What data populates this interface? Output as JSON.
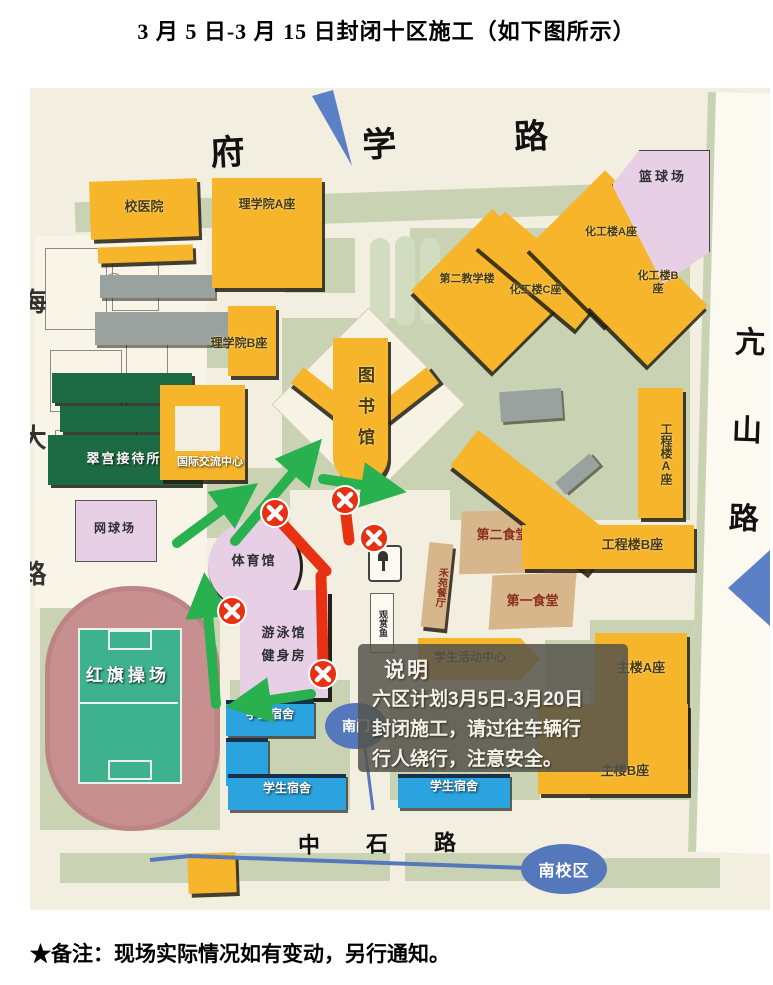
{
  "page": {
    "title": "3 月 5 日-3 月 15 日封闭十区施工（如下图所示）",
    "footnote": "★备注：现场实际情况如有变动，另行通知。"
  },
  "map": {
    "roads": {
      "north": "府学路",
      "east": "亢山路",
      "south": "中石路",
      "west": "海大路"
    },
    "note": {
      "heading": "说明",
      "line1": "六区计划3月5日-3月20日",
      "line2": "封闭施工，请过往车辆行",
      "line3": "行人绕行，注意安全。"
    },
    "markers": {
      "south_gate": "南门",
      "south_campus": "南校区"
    },
    "buildings": {
      "hospital": "校医院",
      "science_a": "理学院A座",
      "science_b": "理学院B座",
      "library": "图书馆",
      "teaching2": "第二教学楼",
      "chem_a": "化工楼A座",
      "chem_b": "化工楼B座",
      "chem_c": "化工楼C座",
      "basketball": "篮球场",
      "cuigong": "翠宫接待所",
      "intl_center": "国际交流中心",
      "tennis": "网球场",
      "gym": "体育馆",
      "swim": "游泳馆",
      "fitness": "健身房",
      "playground": "红旗操场",
      "eng_a": "工程楼A座",
      "eng_b": "工程楼B座",
      "canteen2": "第二食堂",
      "canteen1": "第一食堂",
      "heyuan": "禾苑餐厅",
      "activity": "学生活动中心",
      "main_a": "主楼A座",
      "main_b": "主楼B座",
      "dorm": "学生宿舍",
      "fish_pond": "观赏鱼"
    },
    "colors": {
      "building_yellow": "#f6b52a",
      "closed_red": "#e83012",
      "detour_green": "#28b14e",
      "dorm_blue": "#2aa3df",
      "venue_pink": "#e7cfe5",
      "canteen_tan": "#d8b68c",
      "hotel_green": "#1d6b44",
      "gate_blue": "#5577bb"
    }
  }
}
